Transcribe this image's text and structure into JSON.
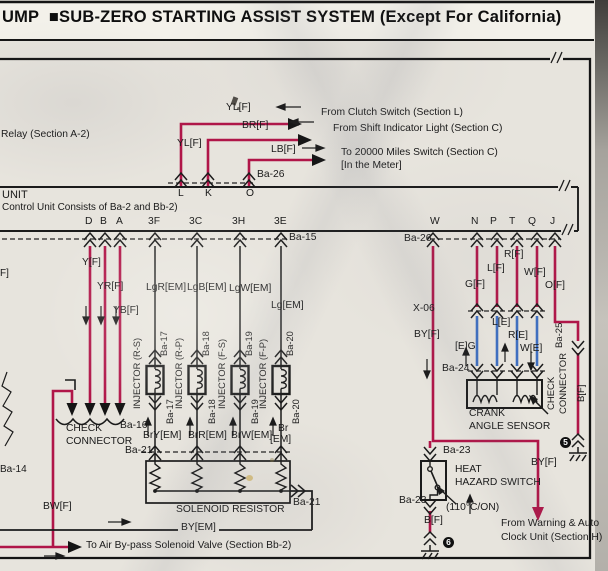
{
  "colors": {
    "wire_magenta": "#b01548",
    "wire_blue": "#3f6fc0",
    "ink": "#1b1b1b",
    "paper": "#e7e4dd"
  },
  "header": {
    "page_word": "UMP",
    "bullet": "■",
    "title": "SUB-ZERO STARTING ASSIST SYSTEM (Except For California)"
  },
  "top": {
    "relay": "Relay (Section A-2)",
    "wire_yl": "YL[F]",
    "wire_yl_vertical": "YL[F]",
    "wire_br": "BR[F]",
    "wire_lb": "LB[F]",
    "to_clutch": "From Clutch Switch (Section L)",
    "to_shift": "From Shift Indicator Light (Section C)",
    "to_miles": "To 20000 Miles Switch (Section C)",
    "to_miles_note": "[In the Meter]",
    "connector": "Ba-26",
    "term_l": "L",
    "term_k": "K",
    "term_o": "O"
  },
  "unit": {
    "name": "UNIT",
    "note": "Control Unit Consists of Ba-2 and Bb-2)",
    "terminals": {
      "d": "D",
      "b": "B",
      "a": "A",
      "f3": "3F",
      "c3": "3C",
      "h3": "3H",
      "e3": "3E",
      "w": "W",
      "n": "N",
      "p": "P",
      "t": "T",
      "q": "Q",
      "j": "J"
    },
    "conn_left": "Ba-15",
    "conn_right": "Ba-26"
  },
  "left": {
    "wire_y": "Y[F]",
    "wire_yr": "YR[F]",
    "wire_yb": "YB[F]",
    "check_line1": "CHECK",
    "check_line2": "CONNECTOR",
    "conn": "Ba-16",
    "wire_bw": "BW[F]",
    "conn_shield": "Ba-14",
    "edge_fragment": "F]",
    "to_bypass": "To Air By-pass Solenoid Valve (Section Bb-2)"
  },
  "injectors": {
    "wire1": "LgR[EM]",
    "wire2": "LgB[EM]",
    "wire3": "LgW[EM]",
    "wire4": "Lg[EM]",
    "name1": "INJECTOR (R-S)",
    "name2": "INJECTOR (R-P)",
    "name3": "INJECTOR (F-S)",
    "name4": "INJECTOR (F-P)",
    "conn1": "Ba-17",
    "conn2": "Ba-18",
    "conn3": "Ba-19",
    "conn4": "Ba-20",
    "wire1b": "BrY[EM]",
    "wire2b": "BrR[EM]",
    "wire3b": "BrW[EM]",
    "wire4b_1": "Br",
    "wire4b_2": "[EM]",
    "conn_row": "Ba-21",
    "conn_out": "Ba-21",
    "resistor": "SOLENOID RESISTOR",
    "wire_out": "BY[EM]"
  },
  "right": {
    "wire_by1": "BY[F]",
    "wire_g": "G[F]",
    "wire_l": "L[F]",
    "wire_r": "R[F]",
    "wire_w": "W[F]",
    "wire_o": "O[F]",
    "conn_x06": "X-06",
    "wire_ge": "[E]G",
    "wire_le": "L[E]",
    "wire_re": "R[E]",
    "wire_we": "W[E]",
    "conn_ba24": "Ba-24",
    "crank_line1": "CRANK",
    "crank_line2": "ANGLE SENSOR",
    "check_line1": "CHECK",
    "check_line2": "CONNECTOR",
    "conn_ba25": "Ba-25",
    "wire_b_right": "B[F]",
    "gnd5": "5",
    "conn_ba23_top": "Ba-23",
    "heat_line1": "HEAT",
    "heat_line2": "HAZARD SWITCH",
    "conn_ba23_bot": "Ba-23",
    "temp_note": "(110°C/ON)",
    "wire_b": "B[F]",
    "gnd6": "6",
    "to_warning_1": "From Warning & Auto",
    "to_warning_2": "Clock Unit (Section H)",
    "wire_by2": "BY[F]"
  }
}
